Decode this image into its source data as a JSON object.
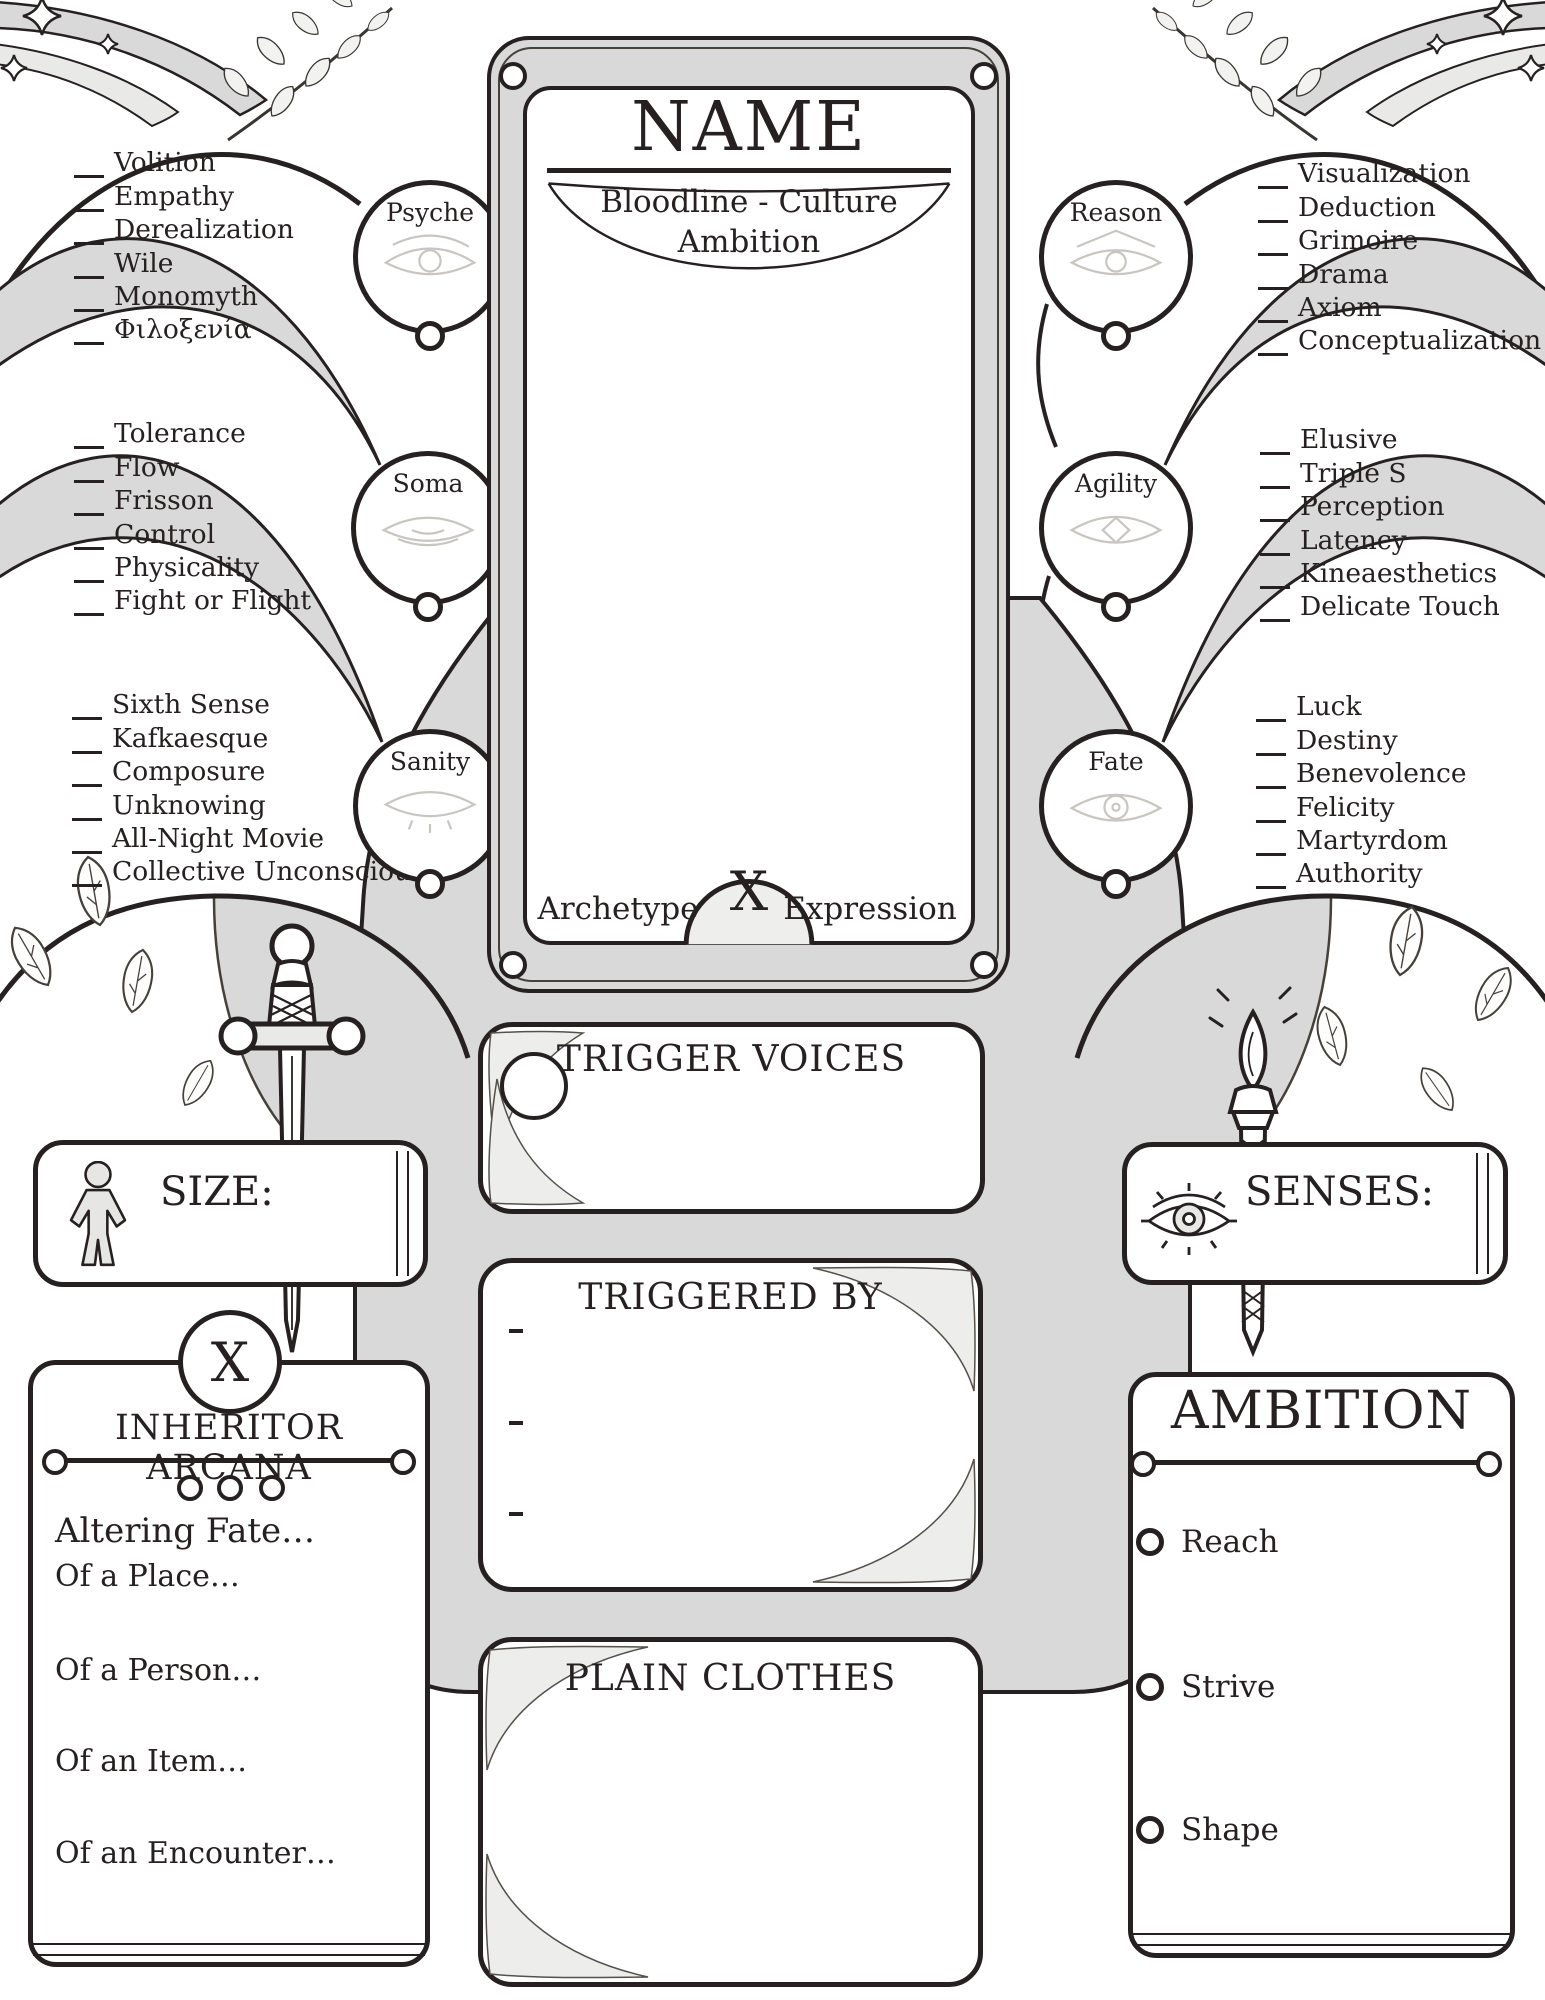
{
  "card": {
    "name_label": "NAME",
    "bloodline_culture_label": "Bloodline - Culture",
    "ambition_label": "Ambition",
    "archetype_label": "Archetype",
    "multiply_label": "X",
    "expression_label": "Expression"
  },
  "attributes": [
    {
      "name": "Psyche",
      "skills": [
        "Volition",
        "Empathy",
        "Derealization",
        "Wile",
        "Monomyth",
        "Φιλοξενία"
      ]
    },
    {
      "name": "Soma",
      "skills": [
        "Tolerance",
        "Flow",
        "Frisson",
        "Control",
        "Physicality",
        "Fight or Flight"
      ]
    },
    {
      "name": "Sanity",
      "skills": [
        "Sixth Sense",
        "Kafkaesque",
        "Composure",
        "Unknowing",
        "All-Night Movie",
        "Collective Unconscious"
      ]
    },
    {
      "name": "Reason",
      "skills": [
        "Visualization",
        "Deduction",
        "Grimoire",
        "Drama",
        "Axiom",
        "Conceptualization"
      ]
    },
    {
      "name": "Agility",
      "skills": [
        "Elusive",
        "Triple S",
        "Perception",
        "Latency",
        "Kineaesthetics",
        "Delicate Touch"
      ]
    },
    {
      "name": "Fate",
      "skills": [
        "Luck",
        "Destiny",
        "Benevolence",
        "Felicity",
        "Martyrdom",
        "Authority"
      ]
    }
  ],
  "sections": {
    "trigger_voices_title": "TRIGGER VOICES",
    "triggered_by_title": "TRIGGERED BY",
    "plain_clothes_title": "PLAIN CLOTHES",
    "size_label": "SIZE:",
    "senses_label": "SENSES:",
    "inheritor_arcana": {
      "marker": "X",
      "title": "INHERITOR ARCANA",
      "items": [
        "Altering Fate…",
        "Of a Place…",
        "Of a Person…",
        "Of an Item…",
        "Of an Encounter…"
      ]
    },
    "ambition_panel": {
      "title": "AMBITION",
      "options": [
        "Reach",
        "Strive",
        "Shape"
      ]
    }
  },
  "icons": {
    "stat_circles": "faint-eye-icon",
    "size": "person-silhouette-icon",
    "senses": "eye-with-lashes-icon",
    "left_emblem": "dagger-icon",
    "right_emblem": "torch-icon",
    "corners": "sparkle-and-laurel-decoration",
    "domes": "leaf-decoration"
  },
  "colors": {
    "ink": "#262120",
    "panel_gray": "#d9d9d9",
    "panel_light": "#ededeb",
    "faint_line": "#c9c6c1",
    "paper": "#ffffff"
  }
}
